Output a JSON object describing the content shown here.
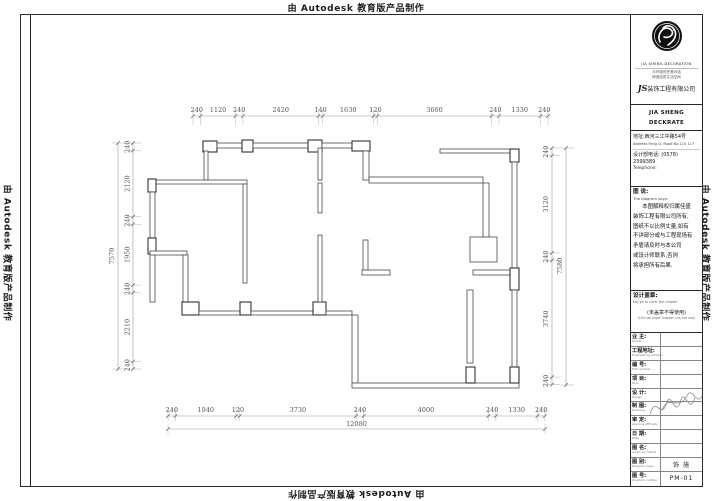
{
  "watermark": {
    "text": "由 Autodesk 教育版产品制作"
  },
  "title_block": {
    "logo_caption": "JIA SHENG DECORATION",
    "tagline1": "与环境的完美对话",
    "tagline2": "缔造品质生活空间",
    "company_prefix": "JS",
    "company_cn": "装饰工程有限公司",
    "company_en1": "JIA SHENG DECKRATE",
    "company_en2": "WOCKRPORATERKS",
    "address_cn": "地址:西河三江中路54号",
    "address_en": "Address Feng Q. Road No.115 117",
    "phone": "设计部电话:  (0578) 2399389",
    "phone_en": "Telephone:",
    "diagram_label": "图 说:",
    "diagram_label_en": "The diagram says:",
    "notes": [
      "本图解释权归属佳盛",
      "装饰工程有限公司所有,",
      "图纸不以比例丈量,如有",
      "不详部分或与工程现场有",
      "矛盾请及时与本公司",
      "或设计师联系,否则",
      "将承担所有后果."
    ],
    "stamp_label": "设计盖章:",
    "stamp_label_en": "Key go to cover the chapter",
    "stamp_note": "(未盖章不得使用)",
    "stamp_note_en": "(Did not cover chapter can not use)",
    "rows": [
      {
        "label": "业 主:",
        "sub": "Owner",
        "value": ""
      },
      {
        "label": "工程地址:",
        "sub": "Engineering address",
        "value": ""
      },
      {
        "label": "编 号:",
        "sub": "Plot number",
        "value": ""
      },
      {
        "label": "项 目:",
        "sub": "Item",
        "value": ""
      },
      {
        "label": "设 计:",
        "sub": "Design",
        "value": ""
      },
      {
        "label": "制 图:",
        "sub": "Drawing",
        "value": ""
      },
      {
        "label": "审 定:",
        "sub": "Approve officially",
        "value": ""
      },
      {
        "label": "日 期:",
        "sub": "Date",
        "value": ""
      },
      {
        "label": "图 名:",
        "sub": "Action for Name",
        "value": ""
      },
      {
        "label": "图 别:",
        "sub": "Diagram class",
        "value": "饰 施"
      },
      {
        "label": "图 号:",
        "sub": "Diagram number",
        "value": "PM-01"
      }
    ]
  },
  "dimensions": {
    "top": [
      "240",
      "1120",
      "240",
      "2420",
      "140",
      "1630",
      "120",
      "3660",
      "240",
      "1330",
      "240"
    ],
    "bottom": [
      "240",
      "1940",
      "120",
      "3730",
      "240",
      "4000",
      "240",
      "1330",
      "240"
    ],
    "bottom_total": "12080",
    "left": [
      "240",
      "2120",
      "240",
      "1950",
      "240",
      "2210",
      "240"
    ],
    "left_total": "7570",
    "right": [
      "240",
      "3120",
      "240",
      "3740",
      "240"
    ],
    "right_total": "7580"
  }
}
